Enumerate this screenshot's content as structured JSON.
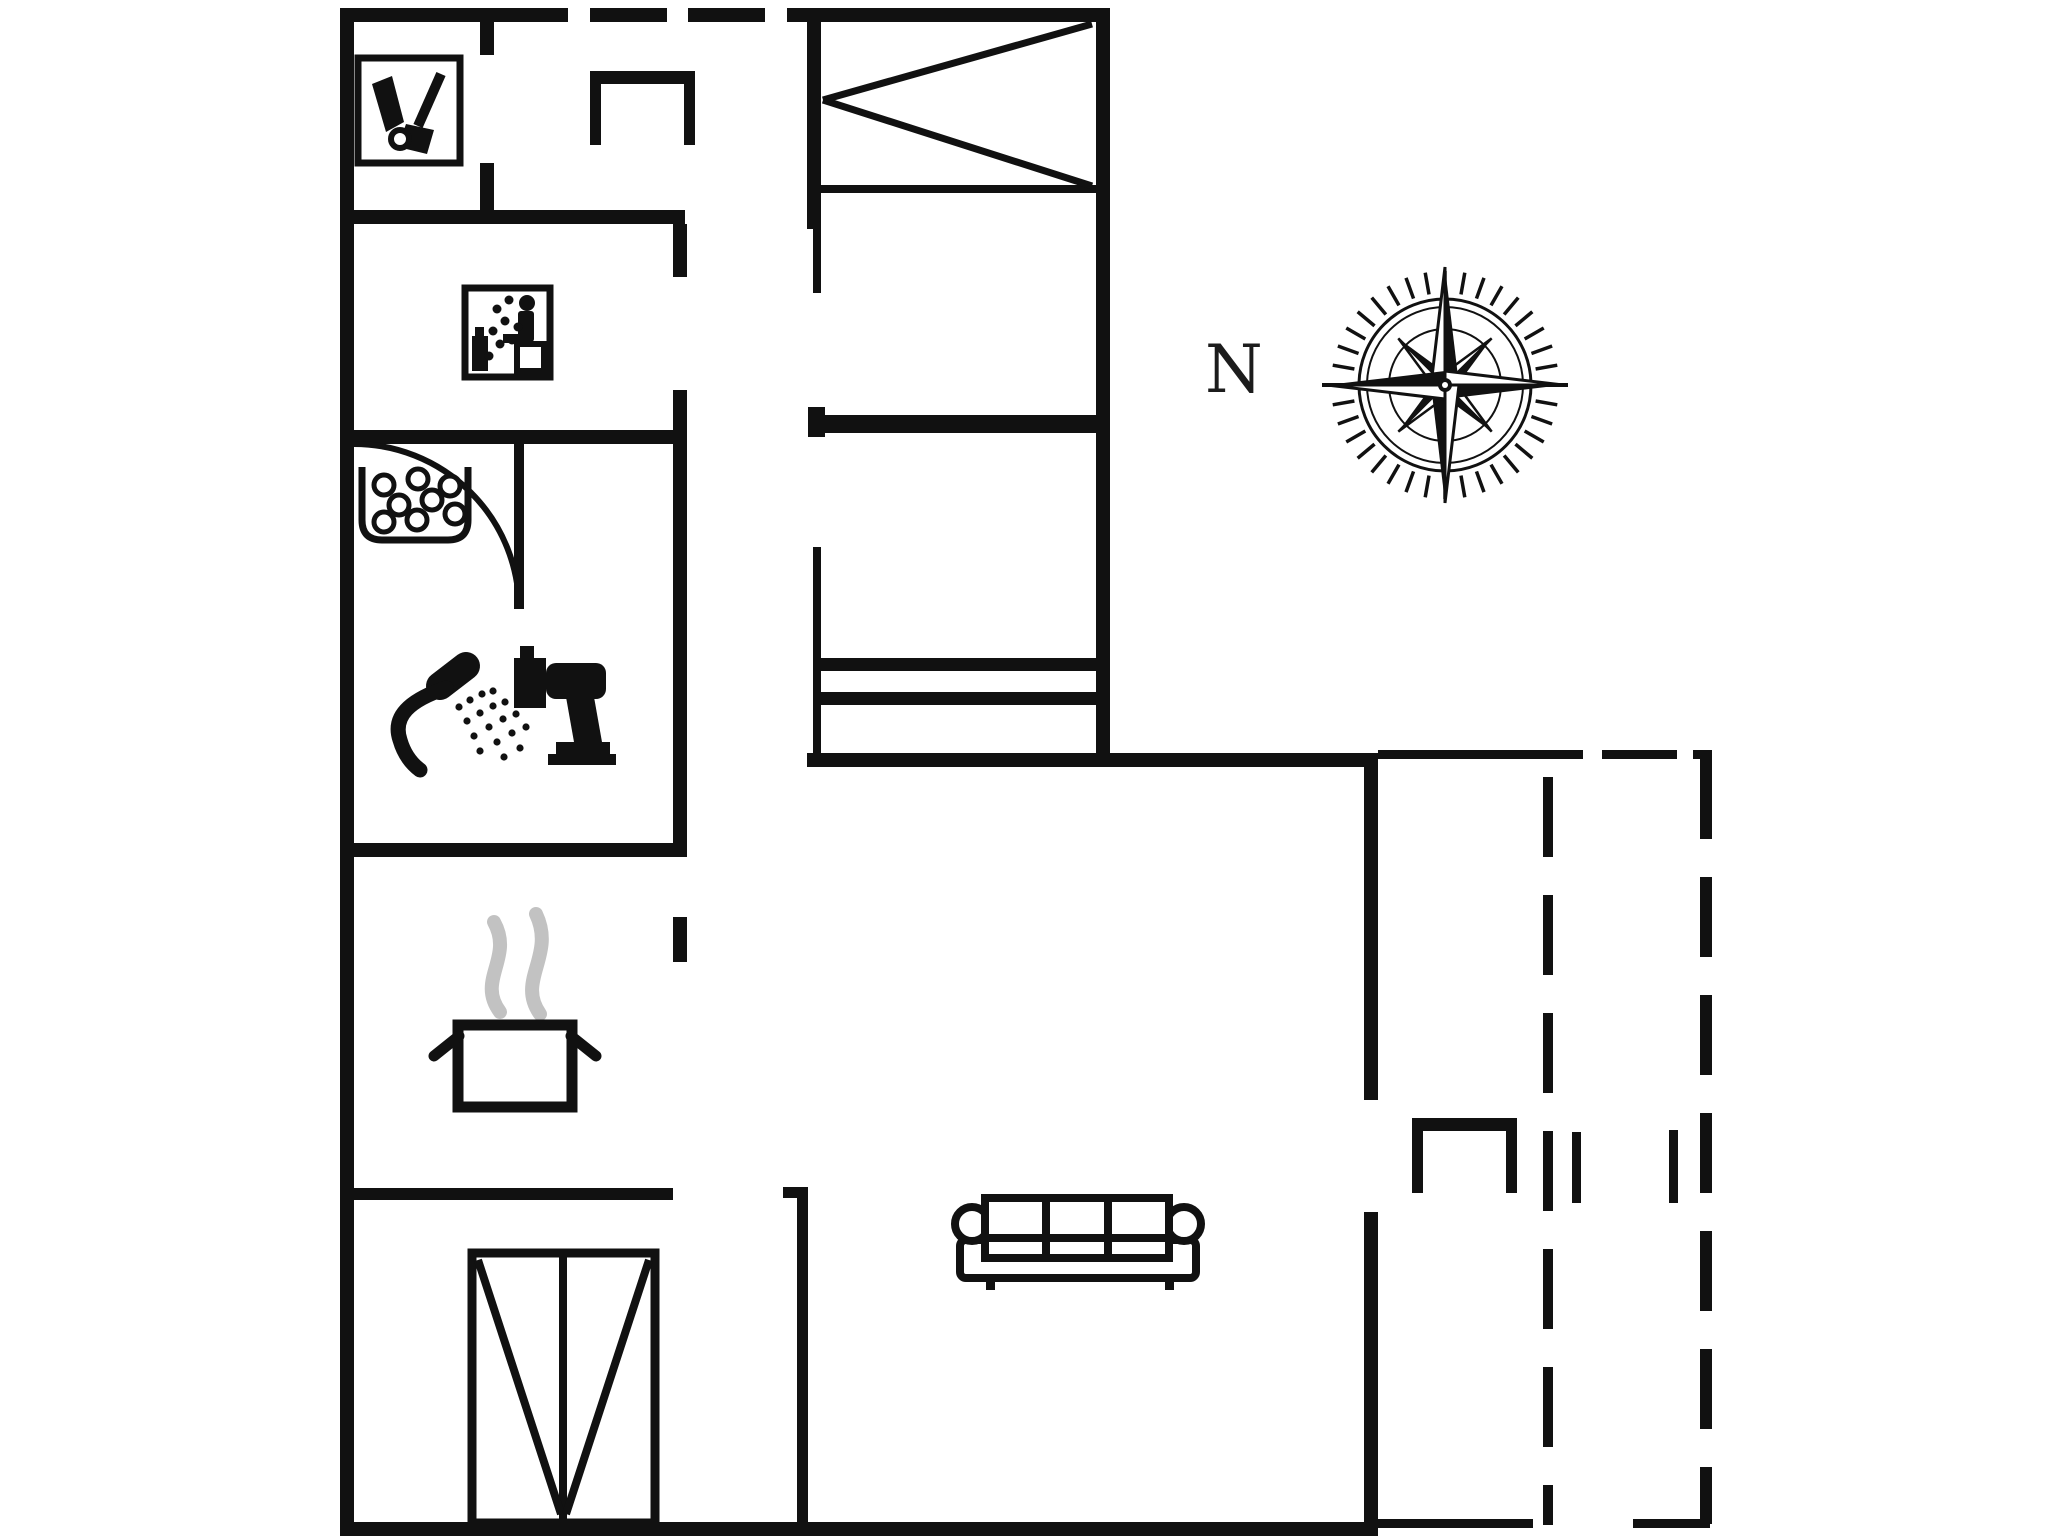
{
  "page": {
    "kind": "holiday-home floor plan drawing",
    "background": "#ffffff"
  },
  "compass": {
    "label": "N"
  },
  "colors": {
    "ink": "#111111",
    "steam": "#c2c2c2",
    "background": "#ffffff"
  },
  "icons": [
    {
      "name": "cleaning-equipment-icon",
      "meaning": "utility room with vacuum and broom"
    },
    {
      "name": "spa-person-icon",
      "meaning": "sauna / spa room with seated person and bubbles"
    },
    {
      "name": "whirlpool-tub-icon",
      "meaning": "whirlpool bath with bubbles"
    },
    {
      "name": "hand-shower-icon",
      "meaning": "shower"
    },
    {
      "name": "toilet-icon",
      "meaning": "WC"
    },
    {
      "name": "cooking-pot-icon",
      "meaning": "kitchen"
    },
    {
      "name": "sofa-icon",
      "meaning": "living room sofa"
    },
    {
      "name": "double-bed-icon",
      "meaning": "bed"
    },
    {
      "name": "wardrobe-icon",
      "meaning": "double wardrobe"
    },
    {
      "name": "closet-symbol",
      "meaning": "open-front cabinet"
    },
    {
      "name": "door-swing-arc",
      "meaning": "door swing"
    },
    {
      "name": "compass-rose-icon",
      "meaning": "north orientation"
    },
    {
      "name": "dashed-terrace-outline",
      "meaning": "covered terrace boundary"
    }
  ]
}
